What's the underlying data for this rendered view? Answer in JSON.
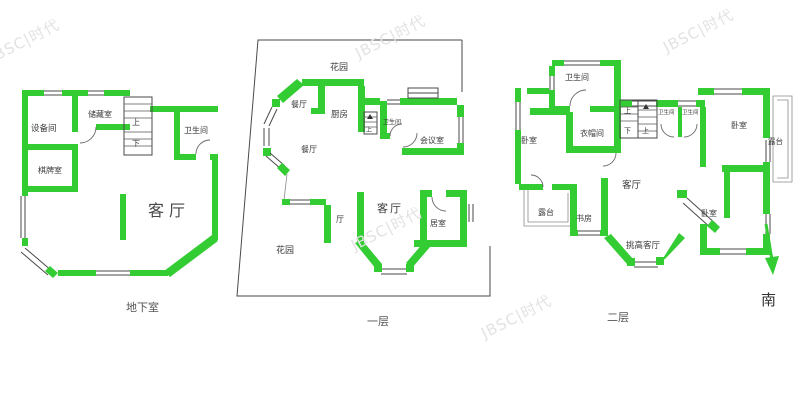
{
  "colors": {
    "wall_green": "#33cc33",
    "line_gray": "#4a4a4a",
    "label_text": "#3a3a3a",
    "watermark": "#e2e2e2"
  },
  "watermarks": {
    "text": "JBSC|时代"
  },
  "compass": {
    "south": "南"
  },
  "floors": {
    "basement": {
      "label": "地下室",
      "rooms": {
        "equipment_room": "设备间",
        "storage_room": "储藏室",
        "bathroom": "卫生间",
        "chess_room": "棋牌室",
        "living_room": "客厅"
      },
      "stairs": {
        "up": "上",
        "down": "下"
      }
    },
    "first_floor": {
      "label": "一层",
      "rooms": {
        "garden_top": "花园",
        "garden_bottom": "花园",
        "dining_upper": "餐厅",
        "dining_lower": "餐厅",
        "kitchen": "厨房",
        "bathroom": "卫生间",
        "meeting_room": "会议室",
        "hall": "厅",
        "living_room": "客厅",
        "bedroom": "居室"
      },
      "stairs": {
        "up": "上"
      }
    },
    "second_floor": {
      "label": "二层",
      "rooms": {
        "bathroom_main": "卫生间",
        "closet": "衣帽间",
        "bedroom_left": "卧室",
        "bathroom_small_1": "卫生间",
        "bathroom_small_2": "卫生间",
        "bedroom_top_right": "卧室",
        "terrace_right": "露台",
        "living_room": "客厅",
        "terrace_left": "露台",
        "study": "书房",
        "bedroom_bottom_right": "卧室",
        "tall_living_room": "挑高客厅"
      },
      "stairs": {
        "up_1": "上",
        "down": "下",
        "up_2": "上"
      }
    }
  }
}
